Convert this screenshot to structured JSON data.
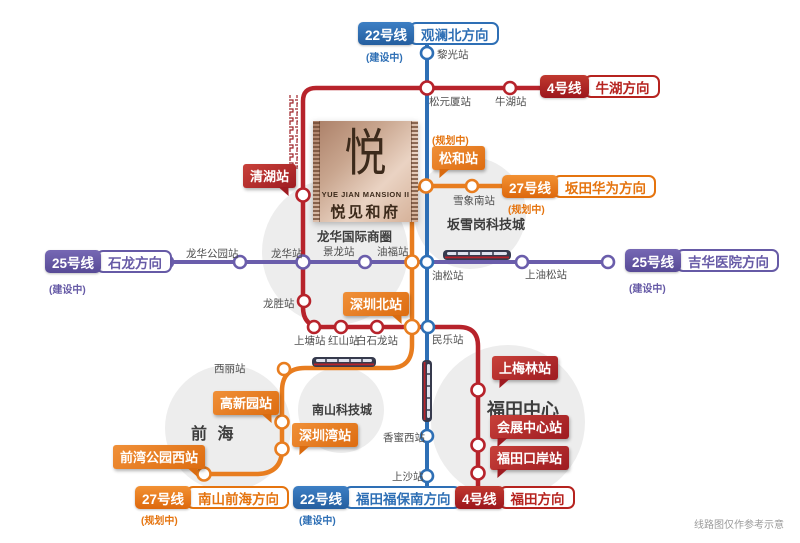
{
  "disclaimer": "线路图仅作参考示意",
  "colors": {
    "line4_red": "#b7232b",
    "line22_blue": "#2e6fb5",
    "line25_purple": "#6a5dab",
    "line27_orange": "#e87d1f",
    "callout_red": "#a81e24",
    "callout_orange": "#e5740f",
    "district_circle_gray": "#ededed",
    "mansion_tan": "#c9a68f"
  },
  "property": {
    "logo": "悦",
    "name_en": "YUE JIAN MANSION II",
    "name_cn": "悦见和府"
  },
  "badges": {
    "l22_north": {
      "line": "22号线",
      "direction": "观澜北方向",
      "status": "(建设中)"
    },
    "l4_niuhu": {
      "line": "4号线",
      "direction": "牛湖方向"
    },
    "l27_bantian": {
      "line": "27号线",
      "direction": "坂田华为方向",
      "status": "(规划中)"
    },
    "l25_jihua": {
      "line": "25号线",
      "direction": "吉华医院方向",
      "status": "(建设中)"
    },
    "l25_shilong": {
      "line": "25号线",
      "direction": "石龙方向",
      "status": "(建设中)"
    },
    "l27_nanshan": {
      "line": "27号线",
      "direction": "南山前海方向",
      "status": "(规划中)"
    },
    "l22_futian": {
      "line": "22号线",
      "direction": "福田福保南方向",
      "status": "(建设中)"
    },
    "l4_futian": {
      "line": "4号线",
      "direction": "福田方向"
    }
  },
  "callouts": {
    "qinghu": "清湖站",
    "songhe": "松和站",
    "songhe_status": "(规划中)",
    "shenzhen_north": "深圳北站",
    "shangmeilin": "上梅林站",
    "convention_center": "会展中心站",
    "futian_checkpoint": "福田口岸站",
    "gaoxinyuan": "高新园站",
    "shenzhen_bay": "深圳湾站",
    "qianwan_park_west": "前湾公园西站"
  },
  "stations": {
    "liguang": "黎光站",
    "songyuanxia": "松元厦站",
    "niuhu": "牛湖站",
    "xuexiangnan": "雪象南站",
    "longhua_park": "龙华公园站",
    "longhua": "龙华站",
    "jinglong": "景龙站",
    "youfu": "油福站",
    "yousong": "油松站",
    "shang_yousong": "上油松站",
    "longsheng": "龙胜站",
    "shangtang": "上塘站",
    "hongshan": "红山站",
    "baishilong": "白石龙站",
    "minle": "民乐站",
    "xili": "西丽站",
    "xiangmixi": "香蜜西站",
    "shangsha": "上沙站"
  },
  "areas": {
    "longhua_cbd": "龙华国际商圈",
    "banxuegang": "坂雪岗科技城",
    "qianhai": "前 海",
    "nanshan_tech": "南山科技城",
    "futian_center": "福田中心"
  }
}
